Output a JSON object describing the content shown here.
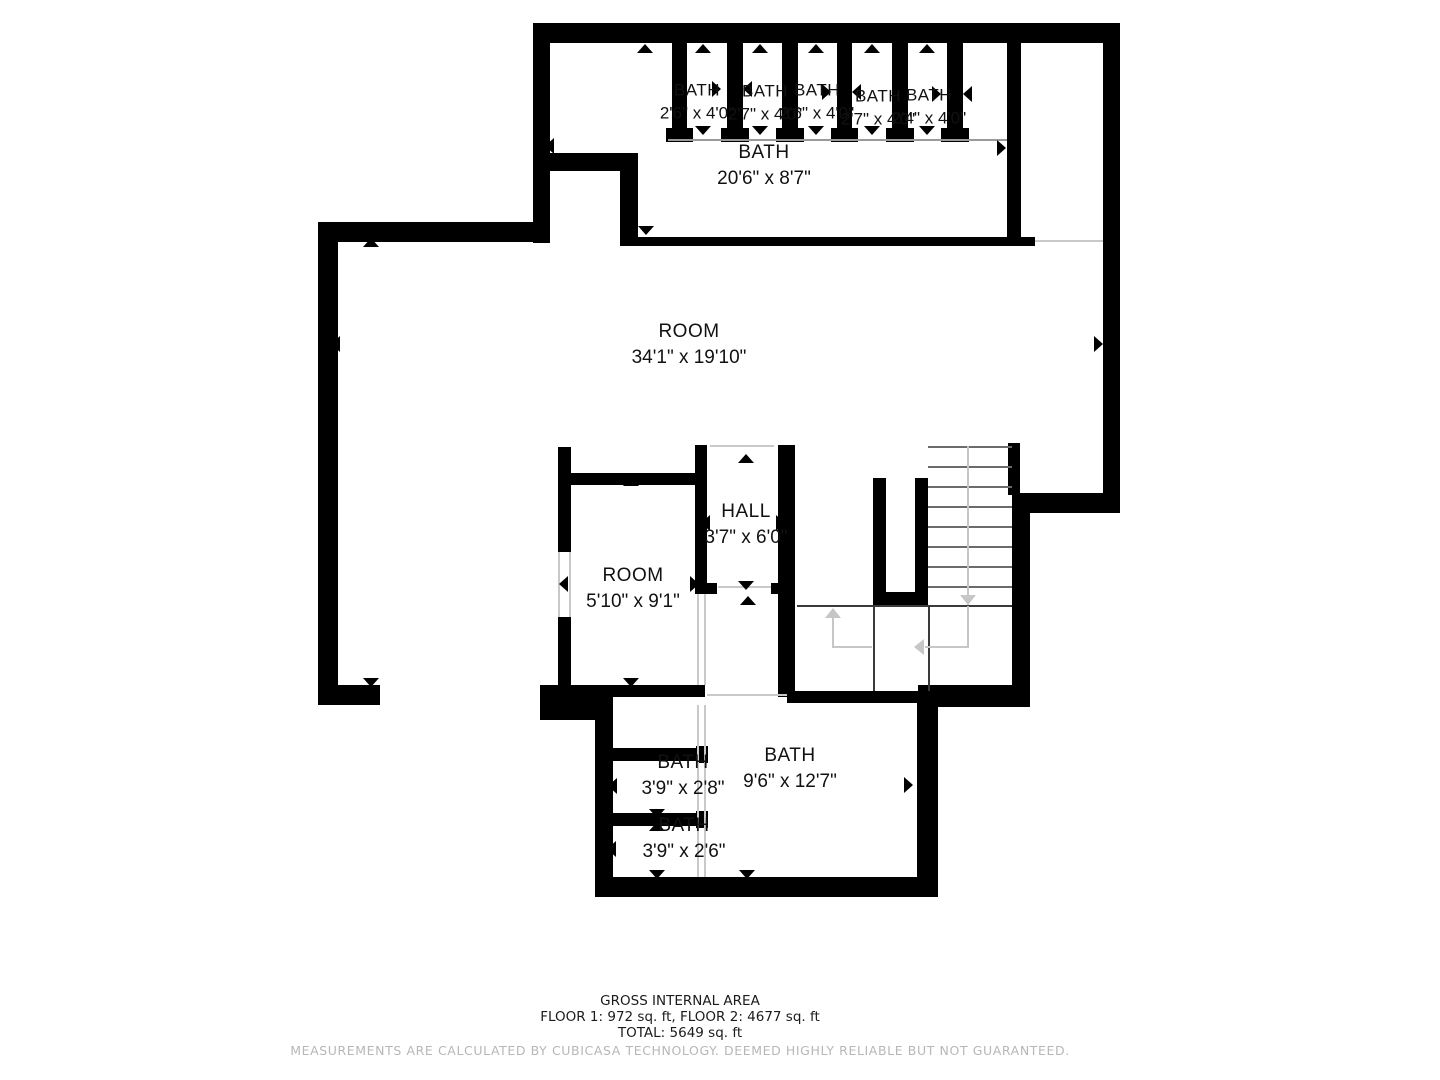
{
  "floorplan": {
    "rooms": {
      "stall1": {
        "label": "BATH",
        "dims": "2'6\" x 4'0\""
      },
      "stall2": {
        "label": "BATH",
        "dims": "2'7\" x 4'0\""
      },
      "stall3": {
        "label": "BATH",
        "dims": "2'6\" x 4'0\""
      },
      "stall4": {
        "label": "BATH",
        "dims": "2'7\" x 4'0\""
      },
      "stall5": {
        "label": "BATH",
        "dims": "2'4\" x 4'0\""
      },
      "bath_top": {
        "label": "BATH",
        "dims": "20'6\" x 8'7\""
      },
      "room_main": {
        "label": "ROOM",
        "dims": "34'1\" x 19'10\""
      },
      "hall": {
        "label": "HALL",
        "dims": "3'7\" x 6'0\""
      },
      "room_small": {
        "label": "ROOM",
        "dims": "5'10\" x 9'1\""
      },
      "bath_large": {
        "label": "BATH",
        "dims": "9'6\" x 12'7\""
      },
      "bath_small1": {
        "label": "BATH",
        "dims": "3'9\" x 2'8\""
      },
      "bath_small2": {
        "label": "BATH",
        "dims": "3'9\" x 2'6\""
      }
    },
    "footer": {
      "title": "GROSS INTERNAL AREA",
      "floors": "FLOOR 1: 972 sq. ft, FLOOR 2: 4677 sq. ft",
      "total": "TOTAL: 5649 sq. ft",
      "disclaimer": "MEASUREMENTS ARE CALCULATED BY CUBICASA TECHNOLOGY. DEEMED HIGHLY RELIABLE BUT NOT GUARANTEED."
    }
  }
}
